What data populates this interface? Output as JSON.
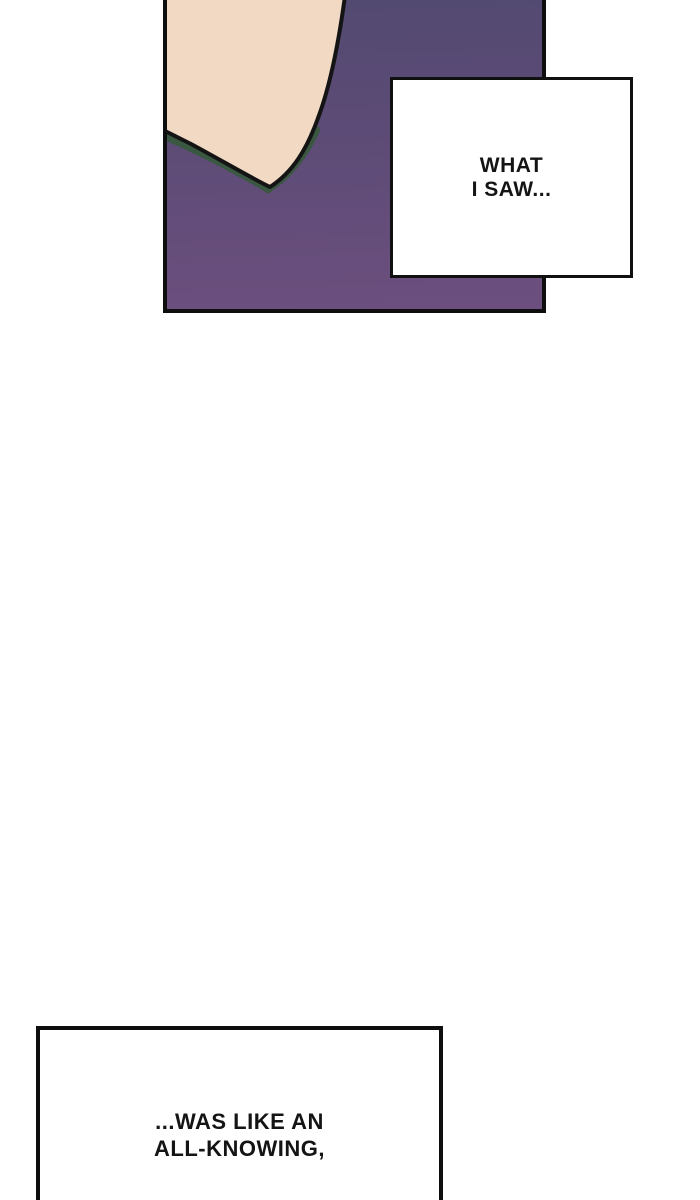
{
  "comic_page": {
    "paper_color": "#ffffff",
    "ink_color": "#141414",
    "panel_top": {
      "background_gradient_top": "#524a71",
      "background_gradient_bottom": "#6c4f7e",
      "skin_tone": "#f2d9c3",
      "outline_color": "#141414",
      "shadow_green": "#3a5741",
      "border_color": "#0e0e0e"
    },
    "caption_top": {
      "line1": "WHAT",
      "line2": "I SAW..."
    },
    "caption_bottom": {
      "line1": "...WAS LIKE AN",
      "line2": "ALL-KNOWING,"
    }
  }
}
